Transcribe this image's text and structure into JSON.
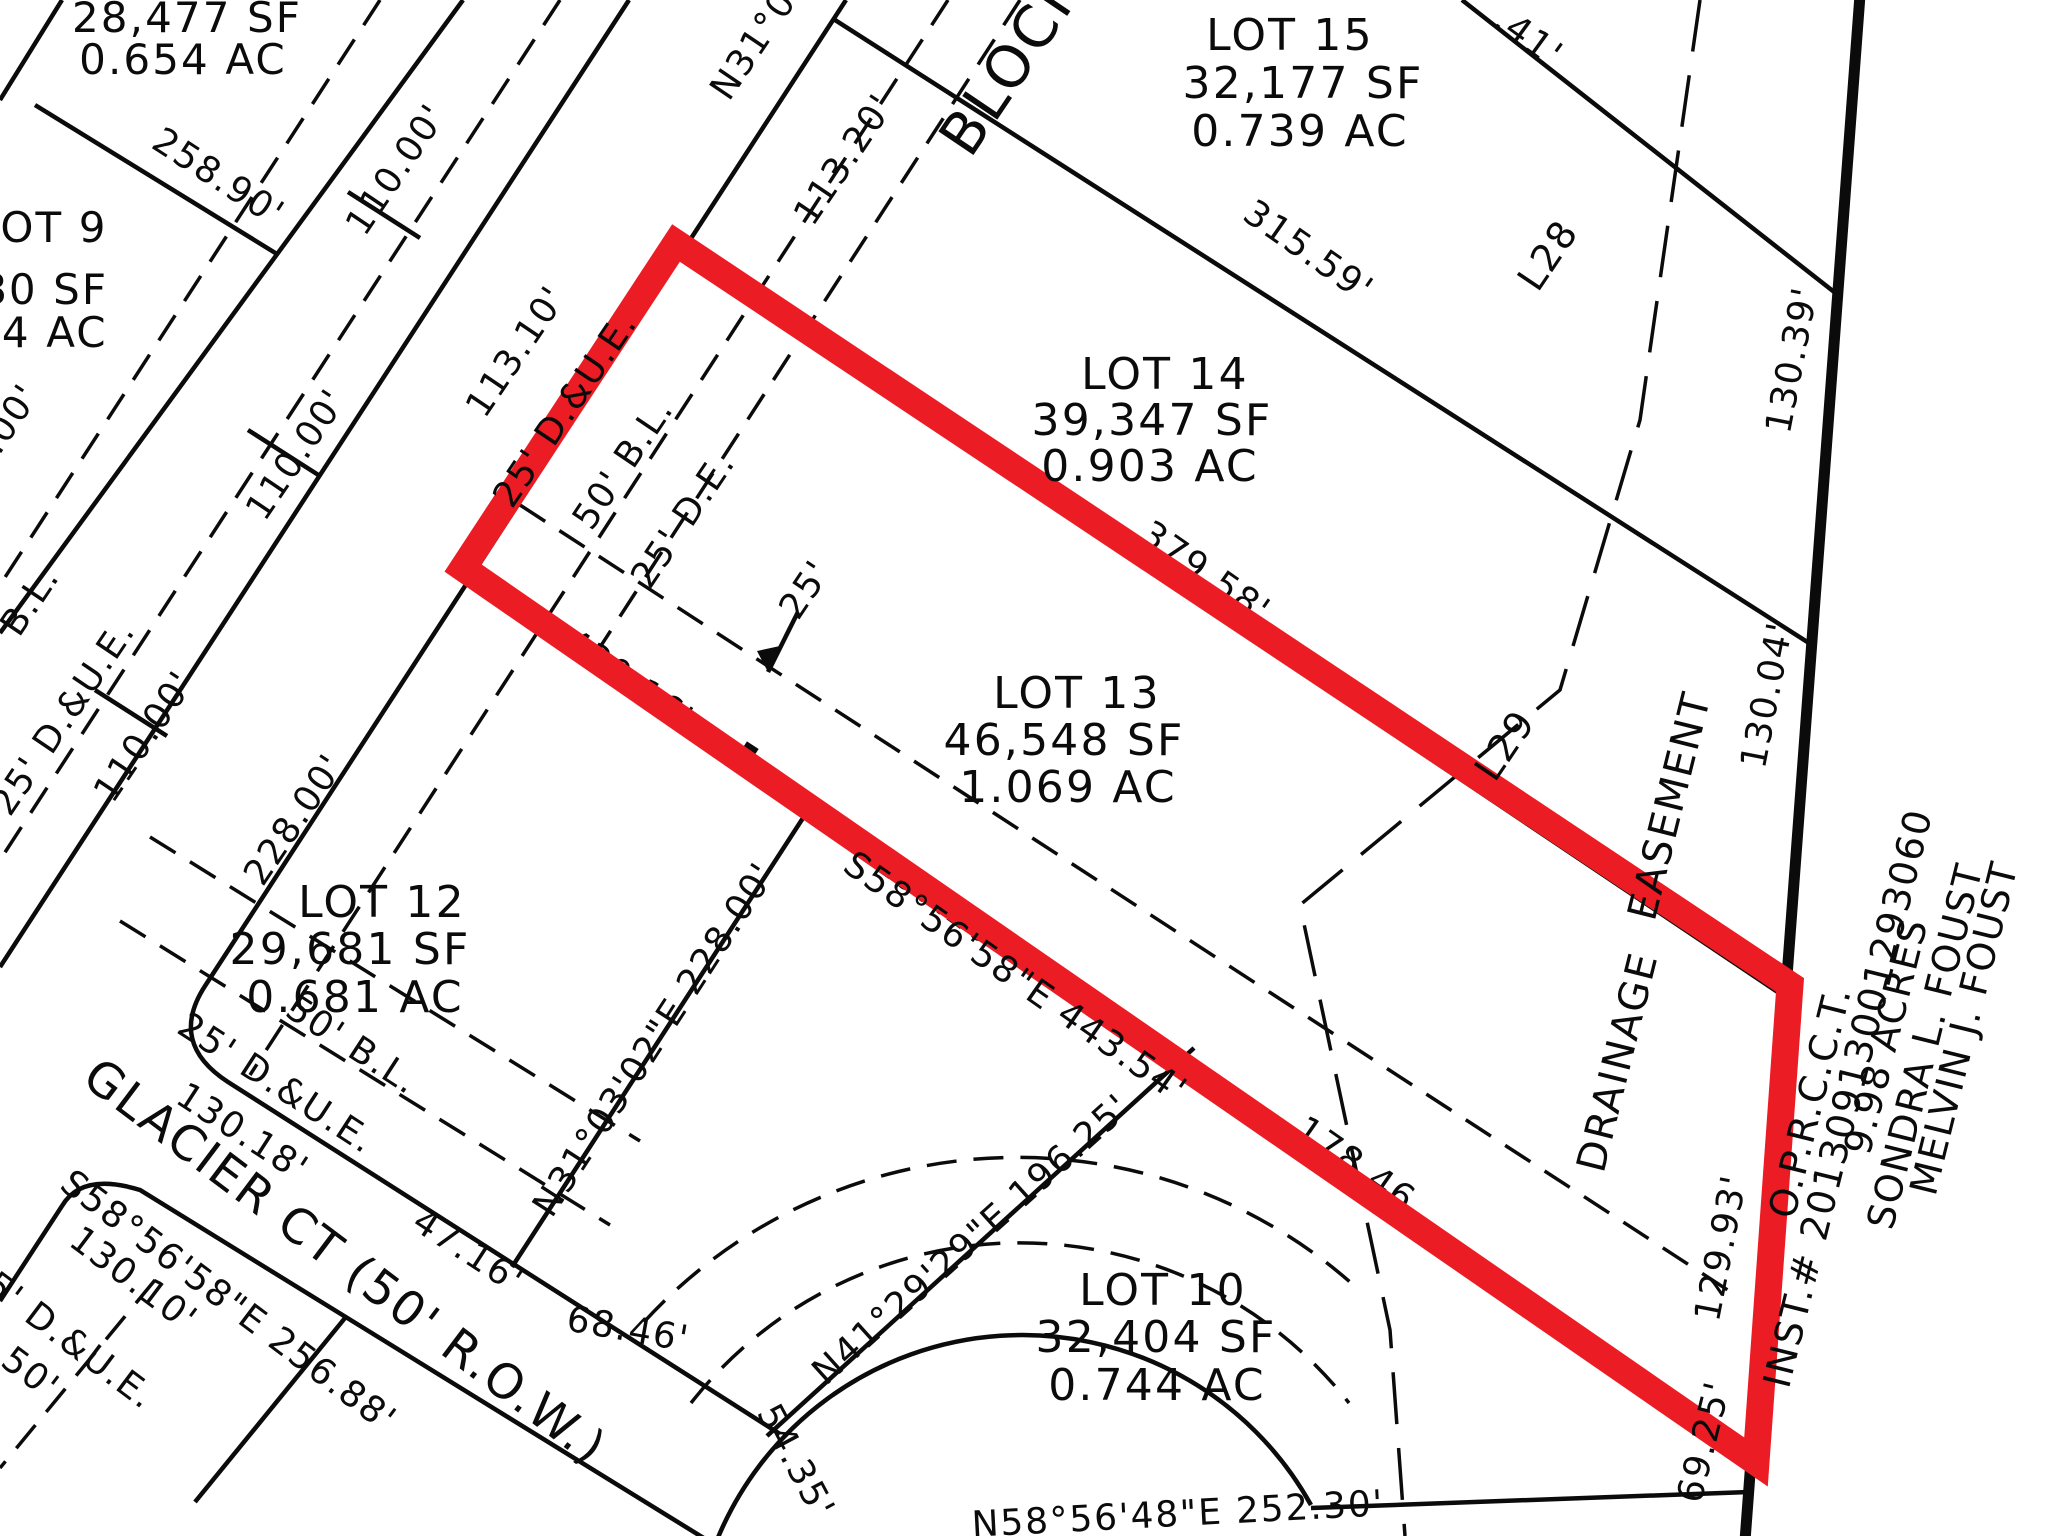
{
  "map": {
    "type": "subdivision-plat",
    "background": "#ffffff",
    "line_color": "#0b0b0b",
    "highlight_color": "#EC1C24",
    "highlighted_lot": "LOT 13",
    "highlight_points": "676,243 1790,985 1756,1462 463,568"
  },
  "street": {
    "name_label": "GLACIER  CT  (50'  R.O.W.)"
  },
  "owner_note": [
    "MELVIN  J.  FOUST",
    "SONDRA  L.  FOUST",
    "9.98  ACRES",
    "INST.#  20130913001293060",
    "O.P.R.C.C.T."
  ],
  "lots": [
    {
      "name": "LOT 9",
      "sf": ",480 SF",
      "ac": "654 AC"
    },
    {
      "name": "LOT 10",
      "sf": "32,404 SF",
      "ac": "0.744 AC"
    },
    {
      "name": "LOT 11",
      "sf": "25,248 SF",
      "ac": "0.580 AC"
    },
    {
      "name": "LOT 12",
      "sf": "29,681 SF",
      "ac": "0.681 AC"
    },
    {
      "name": "LOT 13",
      "sf": "46,548 SF",
      "ac": "1.069 AC"
    },
    {
      "name": "LOT 14",
      "sf": "39,347 SF",
      "ac": "0.903 AC"
    },
    {
      "name": "LOT 15",
      "sf": "32,177 SF",
      "ac": "0.739 AC"
    },
    {
      "name": "(LOT 8 partial)",
      "sf": "28,477 SF",
      "ac": "0.654 AC"
    }
  ],
  "labels": [
    {
      "n": "lot8-area-sf",
      "t": "28,477 SF",
      "x": 187,
      "y": 18,
      "r": 0,
      "s": 42
    },
    {
      "n": "lot8-area-ac",
      "t": "0.654 AC",
      "x": 183,
      "y": 60,
      "r": 0,
      "s": 42
    },
    {
      "n": "dim-258-90",
      "t": "258.90'",
      "x": 218,
      "y": 178,
      "r": 33,
      "s": 36
    },
    {
      "n": "lot9-name",
      "t": "LOT 9",
      "x": 42,
      "y": 228,
      "r": 0,
      "s": 42
    },
    {
      "n": "lot9-sf",
      "t": ",480 SF",
      "x": 22,
      "y": 290,
      "r": 0,
      "s": 42
    },
    {
      "n": "lot9-ac",
      "t": "654 AC",
      "x": 26,
      "y": 333,
      "r": 0,
      "s": 42
    },
    {
      "n": "dim-110-a",
      "t": "110.00'",
      "x": 397,
      "y": 170,
      "r": -56,
      "s": 36
    },
    {
      "n": "dim-110-b",
      "t": "110.00'",
      "x": 297,
      "y": 455,
      "r": -56,
      "s": 36
    },
    {
      "n": "dim-110-c",
      "t": "110.00'",
      "x": 145,
      "y": 737,
      "r": -56,
      "s": 36
    },
    {
      "n": "dim-110-d",
      "t": "110.00'",
      "x": -10,
      "y": 450,
      "r": -56,
      "s": 36
    },
    {
      "n": "bearing-n31-top",
      "t": "N31°03'02\"E",
      "x": 790,
      "y": -8,
      "r": -56,
      "s": 36
    },
    {
      "n": "dim-113-20",
      "t": "113.20'",
      "x": 845,
      "y": 160,
      "r": -56,
      "s": 36
    },
    {
      "n": "block-label",
      "t": "BLOCK",
      "x": 1012,
      "y": 62,
      "r": -56,
      "s": 58
    },
    {
      "n": "lot15-name",
      "t": "LOT 15",
      "x": 1290,
      "y": 36,
      "r": 0,
      "s": 44
    },
    {
      "n": "lot15-sf",
      "t": "32,177 SF",
      "x": 1303,
      "y": 84,
      "r": 0,
      "s": 44
    },
    {
      "n": "lot15-ac",
      "t": "0.739 AC",
      "x": 1300,
      "y": 132,
      "r": 0,
      "s": 44
    },
    {
      "n": "dim-41-partial",
      "t": ".41'",
      "x": 1528,
      "y": 38,
      "r": 36,
      "s": 36
    },
    {
      "n": "dim-315-59",
      "t": "315.59'",
      "x": 1308,
      "y": 252,
      "r": 35,
      "s": 36
    },
    {
      "n": "line-label-L28",
      "t": "L28",
      "x": 1548,
      "y": 255,
      "r": -56,
      "s": 38
    },
    {
      "n": "dim-130-39",
      "t": "130.39'",
      "x": 1793,
      "y": 360,
      "r": -79,
      "s": 36
    },
    {
      "n": "lot14-name",
      "t": "LOT 14",
      "x": 1165,
      "y": 375,
      "r": 0,
      "s": 44
    },
    {
      "n": "lot14-sf",
      "t": "39,347 SF",
      "x": 1152,
      "y": 421,
      "r": 0,
      "s": 44
    },
    {
      "n": "lot14-ac",
      "t": "0.903 AC",
      "x": 1150,
      "y": 467,
      "r": 0,
      "s": 44
    },
    {
      "n": "dim-379-58-obscured",
      "t": "379.58'",
      "x": 1205,
      "y": 573,
      "r": 35,
      "s": 36,
      "u": 1
    },
    {
      "n": "dim-113-10",
      "t": "113.10'",
      "x": 517,
      "y": 352,
      "r": -56,
      "s": 36
    },
    {
      "n": "esmt-25-due",
      "t": "25' D.&U.E.",
      "x": 566,
      "y": 410,
      "r": -56,
      "s": 36
    },
    {
      "n": "esmt-50-bl",
      "t": "50' B.L.",
      "x": 624,
      "y": 464,
      "r": -56,
      "s": 36
    },
    {
      "n": "esmt-25-de",
      "t": "25' D.E.",
      "x": 684,
      "y": 520,
      "r": -56,
      "s": 36
    },
    {
      "n": "arrow-25-label",
      "t": "25'",
      "x": 806,
      "y": 590,
      "r": -56,
      "s": 36
    },
    {
      "n": "lot13-name",
      "t": "LOT 13",
      "x": 1077,
      "y": 694,
      "r": 0,
      "s": 44
    },
    {
      "n": "lot13-sf",
      "t": "46,548 SF",
      "x": 1064,
      "y": 741,
      "r": 0,
      "s": 44
    },
    {
      "n": "lot13-ac",
      "t": "1.069 AC",
      "x": 1068,
      "y": 788,
      "r": 0,
      "s": 44
    },
    {
      "n": "dim-430-16-obscured",
      "t": "430.16'",
      "x": 628,
      "y": 681,
      "r": 35,
      "s": 36,
      "u": 1
    },
    {
      "n": "dim-157-26-obscured",
      "t": "157.26",
      "x": 935,
      "y": 898,
      "r": 35,
      "s": 36,
      "u": 1
    },
    {
      "n": "bearing-s58-443",
      "t": "S58°56'58\"E  443.54'",
      "x": 1015,
      "y": 978,
      "r": 35,
      "s": 36
    },
    {
      "n": "dim-178-46-obscured",
      "t": "178.46",
      "x": 1355,
      "y": 1165,
      "r": 35,
      "s": 36,
      "u": 1
    },
    {
      "n": "line-label-L29",
      "t": "L29",
      "x": 1505,
      "y": 745,
      "r": -56,
      "s": 38
    },
    {
      "n": "drainage-word",
      "t": "DRAINAGE",
      "x": 1618,
      "y": 1062,
      "r": -76,
      "s": 40
    },
    {
      "n": "easement-word",
      "t": "EASEMENT",
      "x": 1670,
      "y": 806,
      "r": -76,
      "s": 40
    },
    {
      "n": "dim-130-04",
      "t": "130.04'",
      "x": 1768,
      "y": 695,
      "r": -79,
      "s": 36
    },
    {
      "n": "dim-129-93",
      "t": "129.93'",
      "x": 1722,
      "y": 1248,
      "r": -79,
      "s": 36
    },
    {
      "n": "dim-69-25",
      "t": "69.25'",
      "x": 1705,
      "y": 1442,
      "r": -76,
      "s": 36
    },
    {
      "n": "lot10-name",
      "t": "LOT 10",
      "x": 1163,
      "y": 1291,
      "r": 0,
      "s": 44
    },
    {
      "n": "lot10-sf",
      "t": "32,404 SF",
      "x": 1156,
      "y": 1338,
      "r": 0,
      "s": 44
    },
    {
      "n": "lot10-ac",
      "t": "0.744 AC",
      "x": 1157,
      "y": 1386,
      "r": 0,
      "s": 44
    },
    {
      "n": "bearing-n41-196",
      "t": "N41°29'29\"E  196.25'",
      "x": 972,
      "y": 1240,
      "r": -42,
      "s": 36
    },
    {
      "n": "dim-54-35",
      "t": "54.35'",
      "x": 795,
      "y": 1462,
      "r": 62,
      "s": 36
    },
    {
      "n": "dim-68-46",
      "t": "68.46'",
      "x": 628,
      "y": 1330,
      "r": 10,
      "s": 36
    },
    {
      "n": "dim-47-16",
      "t": "47.16'",
      "x": 468,
      "y": 1252,
      "r": 33,
      "s": 36
    },
    {
      "n": "bearing-n58-252",
      "t": "N58°56'48\"E  252.30'",
      "x": 1178,
      "y": 1515,
      "r": -3,
      "s": 36
    },
    {
      "n": "bearing-n31-228",
      "t": "N31°03'02\"E 228.00'",
      "x": 655,
      "y": 1040,
      "r": -57,
      "s": 36
    },
    {
      "n": "dim-228-00",
      "t": "228.00'",
      "x": 295,
      "y": 820,
      "r": -56,
      "s": 36
    },
    {
      "n": "lot12-name",
      "t": "LOT 12",
      "x": 382,
      "y": 903,
      "r": 0,
      "s": 44
    },
    {
      "n": "lot12-sf",
      "t": "29,681 SF",
      "x": 350,
      "y": 950,
      "r": 0,
      "s": 44
    },
    {
      "n": "lot12-ac",
      "t": "0.681 AC",
      "x": 355,
      "y": 998,
      "r": 0,
      "s": 44
    },
    {
      "n": "lot12-50-bl",
      "t": "50' B.L.",
      "x": 352,
      "y": 1046,
      "r": 33,
      "s": 36
    },
    {
      "n": "lot12-25-due",
      "t": "25' D.&U.E.",
      "x": 276,
      "y": 1084,
      "r": 33,
      "s": 36
    },
    {
      "n": "dim-130-18",
      "t": "130.18'",
      "x": 242,
      "y": 1133,
      "r": 33,
      "s": 36
    },
    {
      "n": "street-name",
      "t": "GLACIER  CT  (50'  R.O.W.)",
      "x": 345,
      "y": 1262,
      "r": 37,
      "s": 48
    },
    {
      "n": "bearing-s58-256",
      "t": "S58°56'58\"E  256.88'",
      "x": 228,
      "y": 1302,
      "r": 37,
      "s": 36
    },
    {
      "n": "dim-130-10",
      "t": "130.10'",
      "x": 133,
      "y": 1280,
      "r": 37,
      "s": 36
    },
    {
      "n": "sw-25-due",
      "t": "25' D.&U.E.",
      "x": 60,
      "y": 1334,
      "r": 37,
      "s": 36
    },
    {
      "n": "sw-50",
      "t": "50'",
      "x": 30,
      "y": 1374,
      "r": 37,
      "s": 36
    },
    {
      "n": "left-50-bl",
      "t": "50' B.L.",
      "x": 10,
      "y": 632,
      "r": -56,
      "s": 36
    },
    {
      "n": "left-25-due",
      "t": "25' D.&U.E.",
      "x": 64,
      "y": 718,
      "r": -56,
      "s": 36
    },
    {
      "n": "owner-name-1",
      "t": "MELVIN  J.  FOUST",
      "x": 1964,
      "y": 1028,
      "r": -76,
      "s": 38
    },
    {
      "n": "owner-name-2",
      "t": "SONDRA  L.  FOUST",
      "x": 1925,
      "y": 1046,
      "r": -76,
      "s": 38
    },
    {
      "n": "owner-acres",
      "t": "9.98  ACRES",
      "x": 1886,
      "y": 1036,
      "r": -76,
      "s": 38
    },
    {
      "n": "owner-inst",
      "t": "INST.#  20130913001293060",
      "x": 1848,
      "y": 1098,
      "r": -76,
      "s": 38
    },
    {
      "n": "owner-oprcct",
      "t": "O.P.R.C.C.T.",
      "x": 1810,
      "y": 1102,
      "r": -76,
      "s": 38
    }
  ]
}
